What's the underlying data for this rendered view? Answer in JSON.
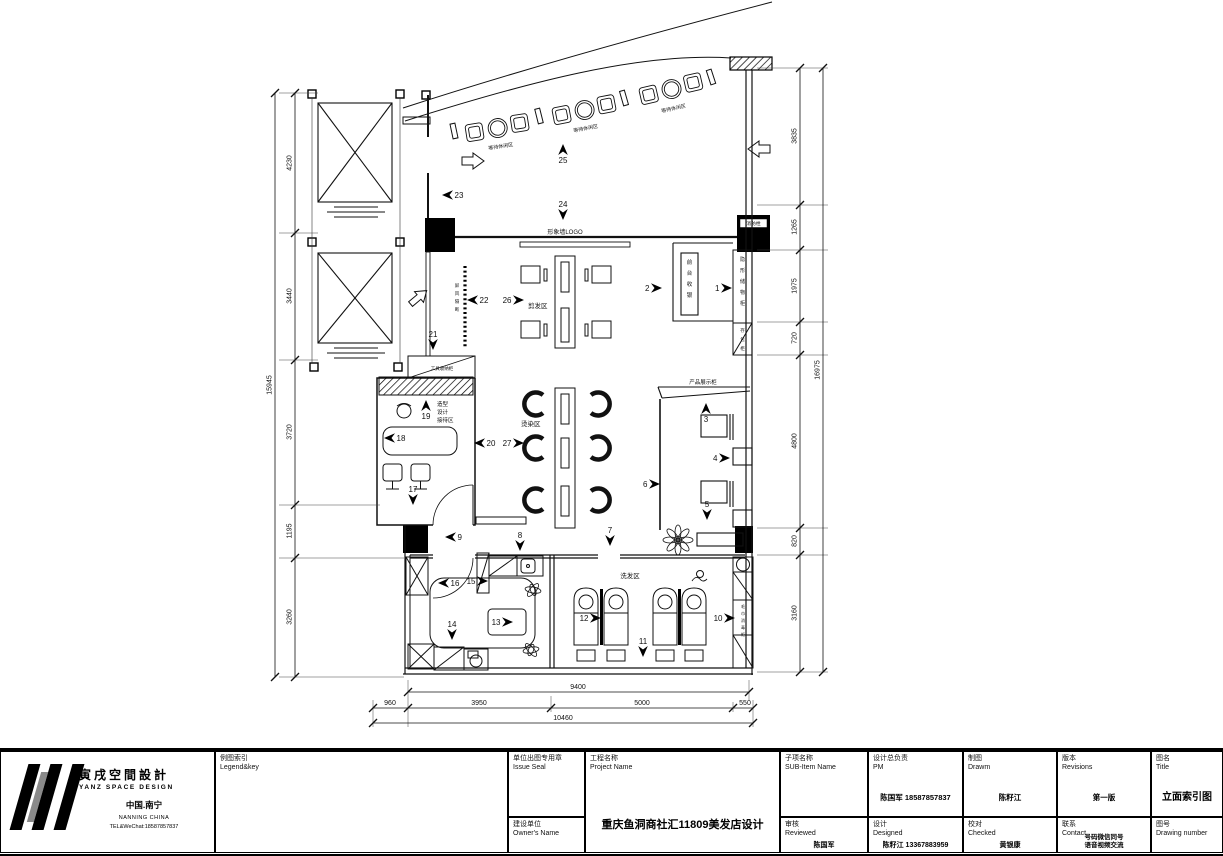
{
  "title_block": {
    "logo": {
      "brand_cn": "寅戌空間設計",
      "brand_en": "YANZ SPACE DESIGN",
      "location_cn": "中国.南宁",
      "location_en": "NANNING CHINA",
      "tel": "TEL&WeChat:18587857837"
    },
    "legend": {
      "label_cn": "例图索引",
      "label_en": "Legend&key"
    },
    "issue_seal": {
      "label_cn": "单位出图专用章",
      "label_en": "Issue Seal"
    },
    "owner": {
      "label_cn": "建设单位",
      "label_en": "Owner's Name"
    },
    "project": {
      "label_cn": "工程名称",
      "label_en": "Project Name",
      "value": "重庆鱼洞商社汇11809美发店设计"
    },
    "sub_item": {
      "label_cn": "子项名称",
      "label_en": "SUB-Item Name"
    },
    "pm": {
      "label_cn": "设计总负责",
      "label_en": "PM",
      "value": "陈国军 18587857837"
    },
    "drawn": {
      "label_cn": "制图",
      "label_en": "Drawm",
      "value": "陈籽江"
    },
    "revisions": {
      "label_cn": "版本",
      "label_en": "Revisions",
      "value": "第一版"
    },
    "sheet_title": {
      "label_cn": "图名",
      "label_en": "Title",
      "value": "立面索引图"
    },
    "reviewed": {
      "label_cn": "审核",
      "label_en": "Reviewed",
      "value": "陈国军"
    },
    "designed": {
      "label_cn": "设计",
      "label_en": "Designed",
      "value": "陈籽江 13367883959"
    },
    "checked": {
      "label_cn": "校对",
      "label_en": "Checked",
      "value": "黄银康"
    },
    "contact": {
      "label_cn": "联系",
      "label_en": "Contact",
      "value_line1": "号码微信同号",
      "value_line2": "语音视频交流"
    },
    "drawing_number": {
      "label_cn": "图号",
      "label_en": "Drawing number"
    }
  },
  "plan": {
    "area_labels": [
      {
        "text": "形象墙LOGO",
        "x": 565,
        "y": 234,
        "size": 6,
        "anchor": "middle"
      },
      {
        "text": "剪发区",
        "x": 528,
        "y": 308,
        "size": 6.5,
        "anchor": "start"
      },
      {
        "text": "烫染区",
        "x": 521,
        "y": 426,
        "size": 6.5,
        "anchor": "start"
      },
      {
        "text": "洗发区",
        "x": 630,
        "y": 578,
        "size": 6.5,
        "anchor": "middle"
      },
      {
        "text": "产品展示柜",
        "x": 703,
        "y": 384,
        "size": 5.5,
        "anchor": "middle"
      },
      {
        "text": "工具收纳柜",
        "x": 442,
        "y": 370,
        "size": 4.5,
        "anchor": "middle"
      },
      {
        "text": "消防栓",
        "x": 753.5,
        "y": 225,
        "size": 4.8,
        "anchor": "middle"
      },
      {
        "text": "造型",
        "x": 437,
        "y": 406,
        "size": 5.5,
        "anchor": "start"
      },
      {
        "text": "设计",
        "x": 437,
        "y": 414,
        "size": 5.5,
        "anchor": "start"
      },
      {
        "text": "接待区",
        "x": 437,
        "y": 422,
        "size": 5.5,
        "anchor": "start"
      },
      {
        "text": "等待休闲区",
        "x": 501,
        "y": 148,
        "size": 5,
        "anchor": "middle",
        "rot": -9
      },
      {
        "text": "等待休闲区",
        "x": 586,
        "y": 130,
        "size": 5,
        "anchor": "middle",
        "rot": -11
      },
      {
        "text": "等待休闲区",
        "x": 674,
        "y": 110,
        "size": 5,
        "anchor": "middle",
        "rot": -13
      }
    ],
    "vertical_labels": [
      {
        "text": "前台收银",
        "x": 689.5,
        "y": 264,
        "size": 5.5,
        "dy": 11
      },
      {
        "text": "隐形储物柜",
        "x": 742.5,
        "y": 261,
        "size": 5,
        "dy": 11
      },
      {
        "text": "存包柜",
        "x": 742.5,
        "y": 332,
        "size": 4.5,
        "dy": 9
      },
      {
        "text": "屏风隔断",
        "x": 457,
        "y": 287,
        "size": 4.5,
        "dy": 8
      },
      {
        "text": "毛巾消毒柜",
        "x": 743,
        "y": 608,
        "size": 4,
        "dy": 7
      }
    ],
    "markers": [
      {
        "n": "1",
        "d": "r",
        "x": 732,
        "y": 288
      },
      {
        "n": "2",
        "d": "r",
        "x": 662,
        "y": 288
      },
      {
        "n": "3",
        "d": "u",
        "x": 706,
        "y": 403
      },
      {
        "n": "4",
        "d": "r",
        "x": 730,
        "y": 458
      },
      {
        "n": "5",
        "d": "d",
        "x": 707,
        "y": 520
      },
      {
        "n": "6",
        "d": "r",
        "x": 660,
        "y": 484
      },
      {
        "n": "7",
        "d": "d",
        "x": 610,
        "y": 546
      },
      {
        "n": "8",
        "d": "d",
        "x": 520,
        "y": 551
      },
      {
        "n": "9",
        "d": "l",
        "x": 445,
        "y": 537
      },
      {
        "n": "10",
        "d": "r",
        "x": 735,
        "y": 618
      },
      {
        "n": "11",
        "d": "d",
        "x": 643,
        "y": 657
      },
      {
        "n": "12",
        "d": "r",
        "x": 601,
        "y": 618
      },
      {
        "n": "13",
        "d": "r",
        "x": 513,
        "y": 622
      },
      {
        "n": "14",
        "d": "d",
        "x": 452,
        "y": 640
      },
      {
        "n": "15",
        "d": "r",
        "x": 488,
        "y": 581
      },
      {
        "n": "16",
        "d": "l",
        "x": 438,
        "y": 583
      },
      {
        "n": "17",
        "d": "d",
        "x": 413,
        "y": 505
      },
      {
        "n": "18",
        "d": "l",
        "x": 384,
        "y": 438
      },
      {
        "n": "19",
        "d": "u",
        "x": 426,
        "y": 400
      },
      {
        "n": "20",
        "d": "l",
        "x": 474,
        "y": 443
      },
      {
        "n": "21",
        "d": "d",
        "x": 433,
        "y": 350
      },
      {
        "n": "22",
        "d": "l",
        "x": 467,
        "y": 300
      },
      {
        "n": "23",
        "d": "l",
        "x": 442,
        "y": 195
      },
      {
        "n": "24",
        "d": "d",
        "x": 563,
        "y": 220
      },
      {
        "n": "25",
        "d": "u",
        "x": 563,
        "y": 144
      },
      {
        "n": "26",
        "d": "r",
        "x": 524,
        "y": 300
      },
      {
        "n": "27",
        "d": "r",
        "x": 524,
        "y": 443
      }
    ],
    "dims": {
      "left_segments": [
        "4230",
        "3440",
        "3720",
        "1195",
        "3260"
      ],
      "left_total": "15945",
      "right_segments": [
        "3835",
        "1265",
        "1975",
        "720",
        "4800",
        "820",
        "3160"
      ],
      "right_total": "16975",
      "bottom_width": "9400",
      "bottom_segments": [
        "960",
        "3950",
        "5000",
        "550"
      ],
      "bottom_total": "10460"
    }
  }
}
